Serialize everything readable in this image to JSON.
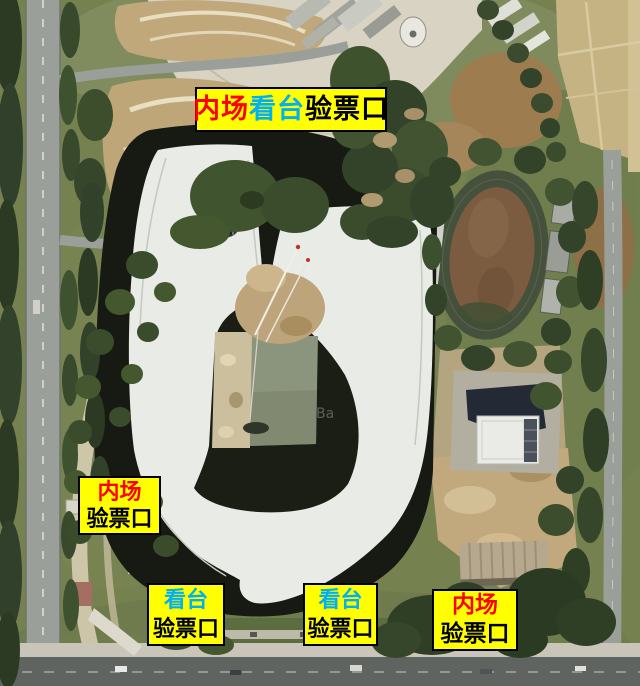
{
  "map": {
    "type": "satellite-imagery-annotation",
    "watermark": "Ba",
    "palette": {
      "label_background": "#ffff00",
      "label_border": "#000000",
      "inner_field_text": "#ff0000",
      "stand_text": "#00b0f0",
      "gate_text": "#000000",
      "vegetation": "#3a4c2b",
      "stadium_shadow": "#171a13",
      "stadium_roof": "#e9ebe6",
      "road": "#9aa099",
      "bare_soil": "#c0a87b"
    }
  },
  "label_style": {
    "background": "#ffff00",
    "border": "#000000"
  },
  "labels": [
    {
      "name": "north-gate-label",
      "lines": [
        [
          {
            "text": "内场",
            "color": "#ff0000"
          },
          {
            "text": "看台",
            "color": "#00b0f0"
          },
          {
            "text": "验票口",
            "color": "#000000"
          }
        ]
      ]
    },
    {
      "name": "west-gate-label",
      "lines": [
        [
          {
            "text": "内场",
            "color": "#ff0000"
          }
        ],
        [
          {
            "text": "验票口",
            "color": "#000000"
          }
        ]
      ]
    },
    {
      "name": "south-stand-gate-label-1",
      "lines": [
        [
          {
            "text": "看台",
            "color": "#00b0f0"
          }
        ],
        [
          {
            "text": "验票口",
            "color": "#000000"
          }
        ]
      ]
    },
    {
      "name": "south-stand-gate-label-2",
      "lines": [
        [
          {
            "text": "看台",
            "color": "#00b0f0"
          }
        ],
        [
          {
            "text": "验票口",
            "color": "#000000"
          }
        ]
      ]
    },
    {
      "name": "southeast-gate-label",
      "lines": [
        [
          {
            "text": "内场",
            "color": "#ff0000"
          }
        ],
        [
          {
            "text": "验票口",
            "color": "#000000"
          }
        ]
      ]
    }
  ]
}
